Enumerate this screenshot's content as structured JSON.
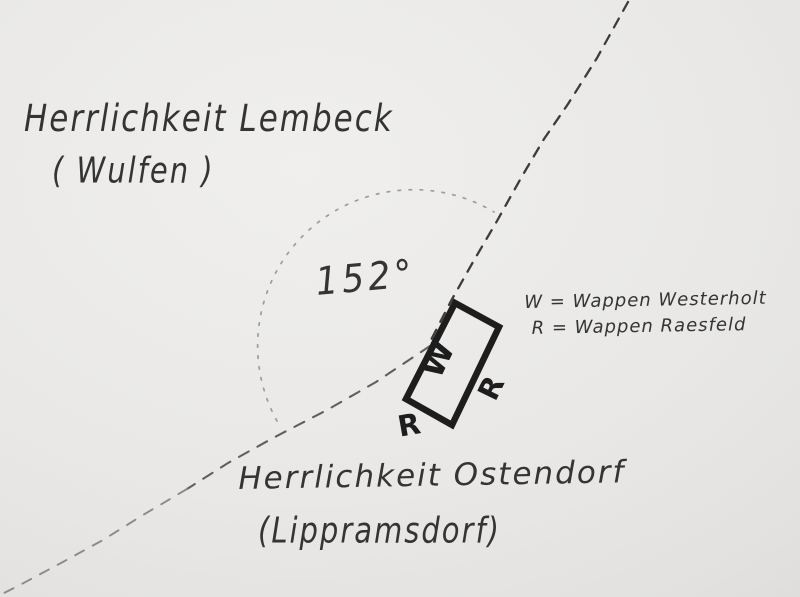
{
  "colors": {
    "paper": "#e9e8e6",
    "handwriting": "#343434",
    "stone_outline": "#1d1d1d",
    "boundary_upper": "#3c3c3c",
    "boundary_lower": "#5f5f5d",
    "boundary_lower_faint": "#8a8a87",
    "angle_arc_dots": "#9c9c99"
  },
  "labels": {
    "territory_top": {
      "name": "Herrlichkeit Lembeck",
      "parenthetical": "( Wulfen )"
    },
    "territory_bottom": {
      "name": "Herrlichkeit Ostendorf",
      "parenthetical": "(Lippramsdorf)"
    },
    "angle": "152°",
    "legend": {
      "line1": "W = Wappen Westerholt",
      "line2": "R = Wappen Raesfeld"
    },
    "stone": {
      "w_side": "W",
      "r_side": "R",
      "r_bottom": "R"
    }
  }
}
